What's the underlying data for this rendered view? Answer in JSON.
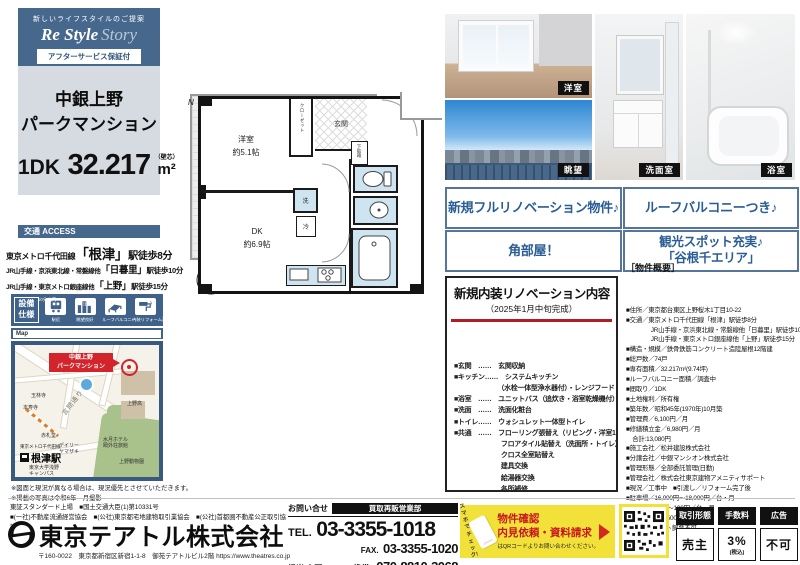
{
  "brand": {
    "tagline": "新しいライフスタイルのご提案",
    "logo_main": "Re Style",
    "logo_sub": "Story",
    "badge": "アフターサービス保証付"
  },
  "property": {
    "name_line1": "中銀上野",
    "name_line2": "パークマンション",
    "plan": "1DK",
    "area": "32.217",
    "area_unit": "m²",
    "area_note": "（壁芯）"
  },
  "access": {
    "header": "交通 ACCESS",
    "main": {
      "prefix": "東京メトロ千代田線",
      "station": "「根津」",
      "suffix": "駅徒歩8分"
    },
    "sub": [
      {
        "prefix": "JR山手線・京浜東北線・常磐線他",
        "station": "「日暮里」",
        "suffix": "駅徒歩10分"
      },
      {
        "prefix": "JR山手線・東京メトロ銀座線他",
        "station": "「上野」",
        "suffix": "駅徒歩15分"
      }
    ]
  },
  "features": {
    "label": "設備\n仕様",
    "items": [
      {
        "icon": "train-icon",
        "burst": "10分以内",
        "label": "駅近"
      },
      {
        "icon": "buildings-icon",
        "burst": "",
        "label": "眺望良好"
      },
      {
        "icon": "balcony-icon",
        "burst": "",
        "label": "ルーフバルコニー"
      },
      {
        "icon": "reform-icon",
        "burst": "",
        "label": "内装リフォーム済"
      }
    ]
  },
  "map": {
    "tab": "Map",
    "marker": "中銀上野\nパークマンション",
    "road": "言問通り",
    "station_line": "東京メトロ千代田線",
    "station": "根津駅",
    "pois": [
      "玉林寺",
      "本寿寺",
      "赤札堂",
      "デイリー\nヤマザキ",
      "上野高",
      "水月ホテル\n鴎外荘旅館",
      "上野動物園",
      "東京大学浅野\nキャンパス"
    ]
  },
  "notes": [
    "※図面と現況が異なる場合は、現況優先とさせていただきます。",
    "※掲載の写真は令和6年　月撮影"
  ],
  "floorplan": {
    "genkan": "玄関",
    "closet": "クローゼット",
    "shoebox": "下駄箱",
    "west_room_l1": "洋室",
    "west_room_l2": "約5.1帖",
    "dk_l1": "DK",
    "dk_l2": "約6.9帖",
    "wash": "洗",
    "fridge": "冷",
    "balcony": "ルーフバルコニー",
    "compass_n": "N"
  },
  "photos": {
    "room": "洋室",
    "view": "眺望",
    "washroom": "洗面室",
    "bathroom": "浴室"
  },
  "catchphrases": [
    "新規フルリノベーション物件♪",
    "ルーフバルコニーつき♪",
    "角部屋！",
    "観光スポット充実♪\n「谷根千エリア」"
  ],
  "renovation": {
    "title": "新規内装リノベーション内容",
    "subtitle": "（2025年1月中旬完成）",
    "items": [
      "■玄関　……　玄関収納",
      "■キッチン……　システムキッチン",
      "　　　　　　　（水栓一体型浄水器付）・レンジフード",
      "■浴室　……　ユニットバス（追炊き・浴室乾燥機付）",
      "■洗面　……　洗面化粧台",
      "■トイレ……　ウォシュレット一体型トイレ",
      "■共通　……　フローリング張替え（リビング・洋室1）",
      "　　　　　　　フロアタイル貼替え（洗面所・トイレ）",
      "　　　　　　　クロス全室貼替え",
      "　　　　　　　建具交換",
      "　　　　　　　給湯器交換",
      "　　　　　　　各所補修",
      "　　　　　　　専有部給排水管更新",
      "　　　　　　　テレビモニター付きインターホン",
      "　　　　　　　ハウスクリーニング"
    ]
  },
  "overview": {
    "title": "［物件概要］",
    "lines": [
      "■住所／東京都台東区上野桜木1丁目10-22",
      "■交通／東京メトロ千代田線「根津」駅徒歩8分",
      "　　　　JR山手線・京浜東北線・常磐線他「日暮里」駅徒歩10分",
      "　　　　JR山手線・東京メトロ銀座線他「上野」駅徒歩15分",
      "■構造・規模／鉄骨鉄筋コンクリート造陸屋根12階建",
      "■総戸数／74戸",
      "■専有面積／32.217m²(9.74坪)",
      "■ルーフバルコニー面積／調査中",
      "■間取り／1DK",
      "■土地権利／所有権",
      "■築年数／昭和45年(1970年)10月築",
      "■管理費／6,100円／月",
      "■修繕積立金／6,980円／月",
      "　合計:13,080円",
      "■施工会社／松井建設株式会社",
      "■分譲会社／中銀マンシオン株式会社",
      "■管理形態／全部委託管理(日勤)",
      "■管理会社／株式会社東京建物アメニティサポート",
      "■現況／工事中　■引渡し／リフォーム完了後",
      "■駐車場／16,000円～18,000円／台・月",
      "■駐輪場／60円～100円／台・月",
      "■バイク置場／500円／台・月",
      "■備考／※ペット飼育不可"
    ]
  },
  "company": {
    "listing": "東証スタンダード上場　■国土交通大臣(1)第10331号",
    "associations": "■(一社)不動産流通経営協会　■(公社)東京都宅地建物取引業協会　■(公社)首都圏不動産公正取引協議会",
    "name": "東京テアトル株式会社",
    "address": "〒160-0022　東京都新宿区新宿1-1-8　御苑テアトルビル2階",
    "url": "https://www.theatres.co.jp"
  },
  "contact": {
    "label": "お問い合せ",
    "dept": "買取再販営業部",
    "tel_label": "TEL.",
    "tel": "03-3355-1018",
    "fax_label": "FAX.",
    "fax": "03-3355-1020",
    "person": "担当/上野",
    "mobile_label": "携帯.",
    "mobile": "070-8810-3068"
  },
  "promo": {
    "check": "スマホで\nチェック!",
    "line1": "物件確認",
    "line2": "内見依頼・資料請求",
    "note": "はQRコードよりお問い合わせください。"
  },
  "deal": [
    {
      "header": "取引形態",
      "value": "売主",
      "note": ""
    },
    {
      "header": "手数料",
      "value": "3%",
      "note": "(税込)"
    },
    {
      "header": "広告",
      "value": "不可",
      "note": ""
    }
  ]
}
